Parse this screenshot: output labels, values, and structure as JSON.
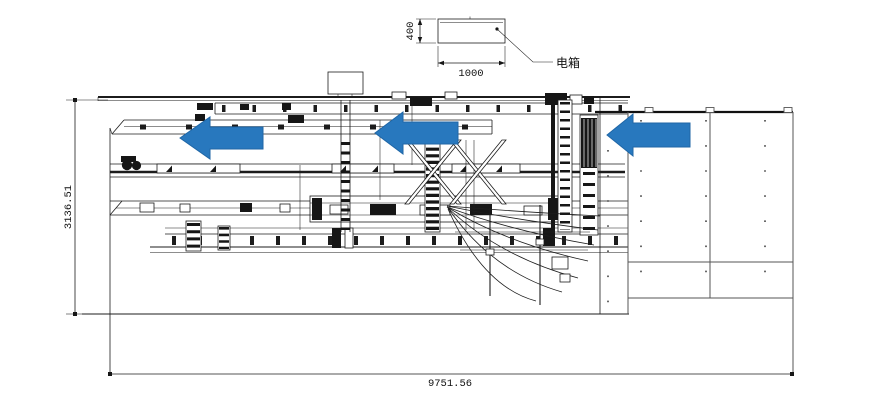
{
  "canvas": {
    "background": "#ffffff"
  },
  "detail_callout": {
    "height_label": "400",
    "width_label": "1000",
    "callout_label": "电箱"
  },
  "overall_dimensions": {
    "height_label": "3136.51",
    "width_label": "9751.56"
  },
  "flow_arrows": {
    "color": "#2878be",
    "border_color": "#1f66a6",
    "direction": "left",
    "count": 3
  },
  "drawing_meta": {
    "line_color": "#1c1c1c",
    "table_line_color": "#555555"
  }
}
